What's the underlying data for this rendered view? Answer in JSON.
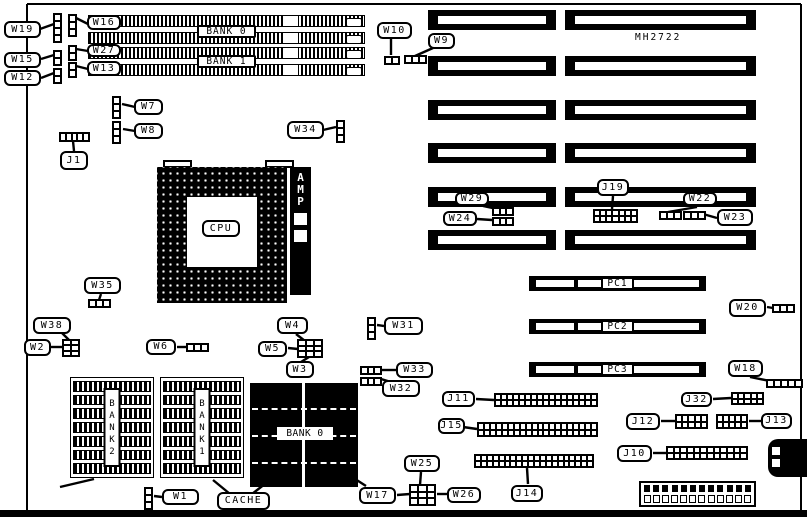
{
  "board": {
    "chipset_text": "MH2722",
    "outline": {
      "left": 27,
      "top": 4,
      "right": 801,
      "bottom_bar_y": 510,
      "bottom_bar_h": 7
    },
    "cpu": {
      "label": "CPU",
      "socket": {
        "x": 157,
        "y": 167,
        "w": 130,
        "h": 136
      },
      "inner": {
        "x": 187,
        "y": 197,
        "w": 70,
        "h": 70
      },
      "tabs": [
        {
          "x": 163,
          "y": 160,
          "w": 29,
          "h": 8
        },
        {
          "x": 265,
          "y": 160,
          "w": 29,
          "h": 8
        }
      ],
      "amp": {
        "text": "AMP",
        "x": 290,
        "y": 167,
        "w": 21,
        "h": 128,
        "windows": [
          {
            "x": 293,
            "y": 212,
            "w": 15,
            "h": 14
          },
          {
            "x": 293,
            "y": 229,
            "w": 15,
            "h": 14
          }
        ]
      }
    },
    "simm": {
      "x": 88,
      "w": 277,
      "h": 12,
      "rows": [
        15,
        32,
        47,
        64
      ]
    },
    "isa": {
      "rows": [
        10,
        56,
        100,
        143,
        187,
        230
      ],
      "h": 20,
      "segments": [
        {
          "x": 428,
          "w": 128
        },
        {
          "x": 565,
          "w": 191
        }
      ]
    },
    "pci": {
      "x": 529,
      "w": 177,
      "h": 15,
      "rows": [
        276,
        319,
        362
      ],
      "labels": [
        "PC1",
        "PC2",
        "PC3"
      ],
      "label_w": 33,
      "label_h": 13
    },
    "cache": {
      "sram_arrays": [
        {
          "name": "BANK 2",
          "x": 70,
          "y": 377,
          "w": 84,
          "h": 101
        },
        {
          "name": "BANK 1",
          "x": 160,
          "y": 377,
          "w": 84,
          "h": 101
        }
      ],
      "data_array": {
        "name": "BANK 0",
        "x": 250,
        "y": 383,
        "w": 108,
        "h": 104
      }
    },
    "power_connector": {
      "x": 639,
      "y": 481,
      "w": 117,
      "h": 26,
      "pins": 12
    },
    "keyboard_connector": {
      "x": 768,
      "y": 439,
      "w": 39,
      "h": 38
    }
  },
  "callouts": [
    {
      "id": "w19",
      "text": "W19",
      "x": 4,
      "y": 21,
      "w": 37,
      "h": 17
    },
    {
      "id": "w15",
      "text": "W15",
      "x": 4,
      "y": 52,
      "w": 37,
      "h": 16
    },
    {
      "id": "w12",
      "text": "W12",
      "x": 4,
      "y": 70,
      "w": 37,
      "h": 16
    },
    {
      "id": "w16",
      "text": "W16",
      "x": 87,
      "y": 15,
      "w": 34,
      "h": 15
    },
    {
      "id": "w27",
      "text": "W27",
      "x": 87,
      "y": 44,
      "w": 34,
      "h": 13
    },
    {
      "id": "w13",
      "text": "W13",
      "x": 87,
      "y": 61,
      "w": 34,
      "h": 15
    },
    {
      "id": "w10",
      "text": "W10",
      "x": 377,
      "y": 22,
      "w": 35,
      "h": 17
    },
    {
      "id": "w9",
      "text": "W9",
      "x": 428,
      "y": 33,
      "w": 27,
      "h": 16
    },
    {
      "id": "w7",
      "text": "W7",
      "x": 134,
      "y": 99,
      "w": 29,
      "h": 16
    },
    {
      "id": "w8",
      "text": "W8",
      "x": 134,
      "y": 123,
      "w": 29,
      "h": 16
    },
    {
      "id": "j1",
      "text": "J1",
      "x": 60,
      "y": 151,
      "w": 28,
      "h": 19
    },
    {
      "id": "w34",
      "text": "W34",
      "x": 287,
      "y": 121,
      "w": 37,
      "h": 18
    },
    {
      "id": "w35",
      "text": "W35",
      "x": 84,
      "y": 277,
      "w": 37,
      "h": 17
    },
    {
      "id": "w29",
      "text": "W29",
      "x": 455,
      "y": 192,
      "w": 34,
      "h": 14
    },
    {
      "id": "w24",
      "text": "W24",
      "x": 443,
      "y": 211,
      "w": 34,
      "h": 15
    },
    {
      "id": "j19",
      "text": "J19",
      "x": 597,
      "y": 179,
      "w": 32,
      "h": 17
    },
    {
      "id": "w22",
      "text": "W22",
      "x": 683,
      "y": 192,
      "w": 34,
      "h": 14
    },
    {
      "id": "w23",
      "text": "W23",
      "x": 717,
      "y": 209,
      "w": 36,
      "h": 17
    },
    {
      "id": "w20",
      "text": "W20",
      "x": 729,
      "y": 299,
      "w": 37,
      "h": 18
    },
    {
      "id": "w18",
      "text": "W18",
      "x": 728,
      "y": 360,
      "w": 35,
      "h": 17
    },
    {
      "id": "w38",
      "text": "W38",
      "x": 33,
      "y": 317,
      "w": 38,
      "h": 17
    },
    {
      "id": "w2",
      "text": "W2",
      "x": 24,
      "y": 339,
      "w": 27,
      "h": 17
    },
    {
      "id": "w6",
      "text": "W6",
      "x": 146,
      "y": 339,
      "w": 30,
      "h": 16
    },
    {
      "id": "w4",
      "text": "W4",
      "x": 277,
      "y": 317,
      "w": 31,
      "h": 17
    },
    {
      "id": "w5",
      "text": "W5",
      "x": 258,
      "y": 341,
      "w": 29,
      "h": 16
    },
    {
      "id": "w3",
      "text": "W3",
      "x": 286,
      "y": 361,
      "w": 28,
      "h": 17
    },
    {
      "id": "w31",
      "text": "W31",
      "x": 384,
      "y": 317,
      "w": 39,
      "h": 18
    },
    {
      "id": "w33",
      "text": "W33",
      "x": 396,
      "y": 362,
      "w": 37,
      "h": 16
    },
    {
      "id": "w32",
      "text": "W32",
      "x": 382,
      "y": 380,
      "w": 38,
      "h": 17
    },
    {
      "id": "w25",
      "text": "W25",
      "x": 404,
      "y": 455,
      "w": 36,
      "h": 17
    },
    {
      "id": "w17",
      "text": "W17",
      "x": 359,
      "y": 487,
      "w": 37,
      "h": 17
    },
    {
      "id": "w26",
      "text": "W26",
      "x": 447,
      "y": 487,
      "w": 34,
      "h": 16
    },
    {
      "id": "j11",
      "text": "J11",
      "x": 442,
      "y": 391,
      "w": 33,
      "h": 16
    },
    {
      "id": "j15",
      "text": "J15",
      "x": 438,
      "y": 418,
      "w": 27,
      "h": 16
    },
    {
      "id": "j14",
      "text": "J14",
      "x": 511,
      "y": 485,
      "w": 32,
      "h": 17
    },
    {
      "id": "j32",
      "text": "J32",
      "x": 681,
      "y": 392,
      "w": 31,
      "h": 15
    },
    {
      "id": "j12",
      "text": "J12",
      "x": 626,
      "y": 413,
      "w": 34,
      "h": 17
    },
    {
      "id": "j13",
      "text": "J13",
      "x": 761,
      "y": 413,
      "w": 31,
      "h": 16
    },
    {
      "id": "j10",
      "text": "J10",
      "x": 617,
      "y": 445,
      "w": 35,
      "h": 17
    },
    {
      "id": "w1",
      "text": "W1",
      "x": 162,
      "y": 489,
      "w": 37,
      "h": 16
    },
    {
      "id": "cache",
      "text": "CACHE",
      "x": 217,
      "y": 492,
      "w": 53,
      "h": 18
    },
    {
      "id": "cpu",
      "text": "CPU",
      "x": 202,
      "y": 220,
      "w": 38,
      "h": 17
    },
    {
      "id": "simm-bank0",
      "text": "BANK 0",
      "x": 197,
      "y": 25,
      "w": 59,
      "h": 13,
      "variant": "square"
    },
    {
      "id": "simm-bank1",
      "text": "BANK 1",
      "x": 197,
      "y": 55,
      "w": 59,
      "h": 13,
      "variant": "square"
    },
    {
      "id": "cache-bank0",
      "text": "BANK 0",
      "x": 277,
      "y": 427,
      "w": 56,
      "h": 13,
      "variant": "plain"
    }
  ],
  "pin_headers": [
    {
      "id": "j1",
      "x": 59,
      "y": 132,
      "w": 31,
      "h": 10,
      "cols": 5,
      "rows": 1
    },
    {
      "id": "j19",
      "x": 593,
      "y": 209,
      "w": 45,
      "h": 14,
      "cols": 7,
      "rows": 2
    },
    {
      "id": "j11",
      "x": 494,
      "y": 393,
      "w": 104,
      "h": 14,
      "cols": 17,
      "rows": 2
    },
    {
      "id": "j15",
      "x": 477,
      "y": 422,
      "w": 121,
      "h": 15,
      "cols": 20,
      "rows": 2
    },
    {
      "id": "j14",
      "x": 474,
      "y": 454,
      "w": 120,
      "h": 14,
      "cols": 20,
      "rows": 2
    },
    {
      "id": "j32",
      "x": 731,
      "y": 392,
      "w": 33,
      "h": 13,
      "cols": 5,
      "rows": 2
    },
    {
      "id": "j12",
      "x": 675,
      "y": 414,
      "w": 33,
      "h": 15,
      "cols": 5,
      "rows": 2
    },
    {
      "id": "j13",
      "x": 716,
      "y": 414,
      "w": 32,
      "h": 15,
      "cols": 5,
      "rows": 2
    },
    {
      "id": "j10",
      "x": 666,
      "y": 446,
      "w": 82,
      "h": 14,
      "cols": 12,
      "rows": 2
    },
    {
      "id": "w38-w2-block",
      "x": 62,
      "y": 339,
      "w": 18,
      "h": 18,
      "cols": 2,
      "rows": 3
    },
    {
      "id": "w4-w5-w3-block",
      "x": 297,
      "y": 339,
      "w": 26,
      "h": 19,
      "cols": 3,
      "rows": 3
    },
    {
      "id": "w17-w25-w26-block",
      "x": 409,
      "y": 484,
      "w": 27,
      "h": 22,
      "cols": 3,
      "rows": 3
    },
    {
      "id": "w29",
      "x": 492,
      "y": 207,
      "w": 22,
      "h": 9,
      "cols": 3,
      "rows": 1
    },
    {
      "id": "w24",
      "x": 492,
      "y": 217,
      "w": 22,
      "h": 9,
      "cols": 3,
      "rows": 1
    },
    {
      "id": "w33",
      "x": 360,
      "y": 366,
      "w": 22,
      "h": 9,
      "cols": 3,
      "rows": 1
    },
    {
      "id": "w32",
      "x": 360,
      "y": 377,
      "w": 22,
      "h": 9,
      "cols": 3,
      "rows": 1
    }
  ],
  "jumper_strips": [
    {
      "id": "w19",
      "x": 53,
      "y": 13,
      "orient": "v",
      "pins": 4
    },
    {
      "id": "w15",
      "x": 53,
      "y": 50,
      "orient": "v",
      "pins": 2
    },
    {
      "id": "w12",
      "x": 53,
      "y": 68,
      "orient": "v",
      "pins": 2
    },
    {
      "id": "w16",
      "x": 68,
      "y": 14,
      "orient": "v",
      "pins": 3
    },
    {
      "id": "w27",
      "x": 68,
      "y": 45,
      "orient": "v",
      "pins": 2
    },
    {
      "id": "w13",
      "x": 68,
      "y": 62,
      "orient": "v",
      "pins": 2
    },
    {
      "id": "w10",
      "x": 384,
      "y": 56,
      "orient": "h",
      "pins": 2
    },
    {
      "id": "w9",
      "x": 404,
      "y": 55,
      "orient": "h",
      "pins": 3
    },
    {
      "id": "w7",
      "x": 112,
      "y": 96,
      "orient": "v",
      "pins": 3
    },
    {
      "id": "w8",
      "x": 112,
      "y": 121,
      "orient": "v",
      "pins": 3
    },
    {
      "id": "w34",
      "x": 336,
      "y": 120,
      "orient": "v",
      "pins": 3
    },
    {
      "id": "w35",
      "x": 88,
      "y": 299,
      "orient": "h",
      "pins": 3
    },
    {
      "id": "w22",
      "x": 659,
      "y": 211,
      "orient": "h",
      "pins": 3
    },
    {
      "id": "w23",
      "x": 683,
      "y": 211,
      "orient": "h",
      "pins": 3
    },
    {
      "id": "w20",
      "x": 772,
      "y": 304,
      "orient": "h",
      "pins": 3
    },
    {
      "id": "w18",
      "x": 766,
      "y": 379,
      "orient": "h",
      "pins": 5
    },
    {
      "id": "w6",
      "x": 186,
      "y": 343,
      "orient": "h",
      "pins": 3
    },
    {
      "id": "w31",
      "x": 367,
      "y": 317,
      "orient": "v",
      "pins": 3
    },
    {
      "id": "w1",
      "x": 144,
      "y": 487,
      "orient": "v",
      "pins": 3
    }
  ],
  "leaders": [
    [
      40,
      29,
      54,
      24
    ],
    [
      41,
      59,
      54,
      55
    ],
    [
      41,
      78,
      54,
      73
    ],
    [
      88,
      24,
      76,
      18
    ],
    [
      88,
      51,
      76,
      49
    ],
    [
      88,
      69,
      76,
      66
    ],
    [
      391,
      39,
      391,
      55
    ],
    [
      433,
      48,
      415,
      56
    ],
    [
      135,
      107,
      122,
      104
    ],
    [
      135,
      131,
      123,
      129
    ],
    [
      74,
      151,
      73,
      141
    ],
    [
      323,
      130,
      336,
      127
    ],
    [
      101,
      294,
      99,
      300
    ],
    [
      483,
      206,
      497,
      209
    ],
    [
      477,
      219,
      492,
      220
    ],
    [
      613,
      196,
      612,
      209
    ],
    [
      697,
      207,
      668,
      212
    ],
    [
      717,
      218,
      703,
      214
    ],
    [
      767,
      307,
      773,
      308
    ],
    [
      750,
      377,
      770,
      381
    ],
    [
      62,
      333,
      70,
      341
    ],
    [
      51,
      347,
      63,
      347
    ],
    [
      177,
      347,
      187,
      347
    ],
    [
      296,
      334,
      305,
      341
    ],
    [
      288,
      348,
      298,
      349
    ],
    [
      301,
      362,
      309,
      357
    ],
    [
      384,
      326,
      377,
      325
    ],
    [
      396,
      370,
      382,
      370
    ],
    [
      391,
      382,
      381,
      379
    ],
    [
      421,
      472,
      420,
      485
    ],
    [
      397,
      495,
      410,
      494
    ],
    [
      447,
      494,
      437,
      494
    ],
    [
      476,
      399,
      494,
      400
    ],
    [
      463,
      427,
      477,
      429
    ],
    [
      528,
      484,
      527,
      468
    ],
    [
      713,
      399,
      731,
      398
    ],
    [
      661,
      421,
      675,
      421
    ],
    [
      761,
      421,
      749,
      421
    ],
    [
      653,
      453,
      666,
      453
    ],
    [
      162,
      497,
      154,
      496
    ],
    [
      60,
      487,
      94,
      479
    ],
    [
      230,
      494,
      213,
      480
    ],
    [
      252,
      494,
      270,
      480
    ],
    [
      352,
      477,
      366,
      486
    ]
  ]
}
